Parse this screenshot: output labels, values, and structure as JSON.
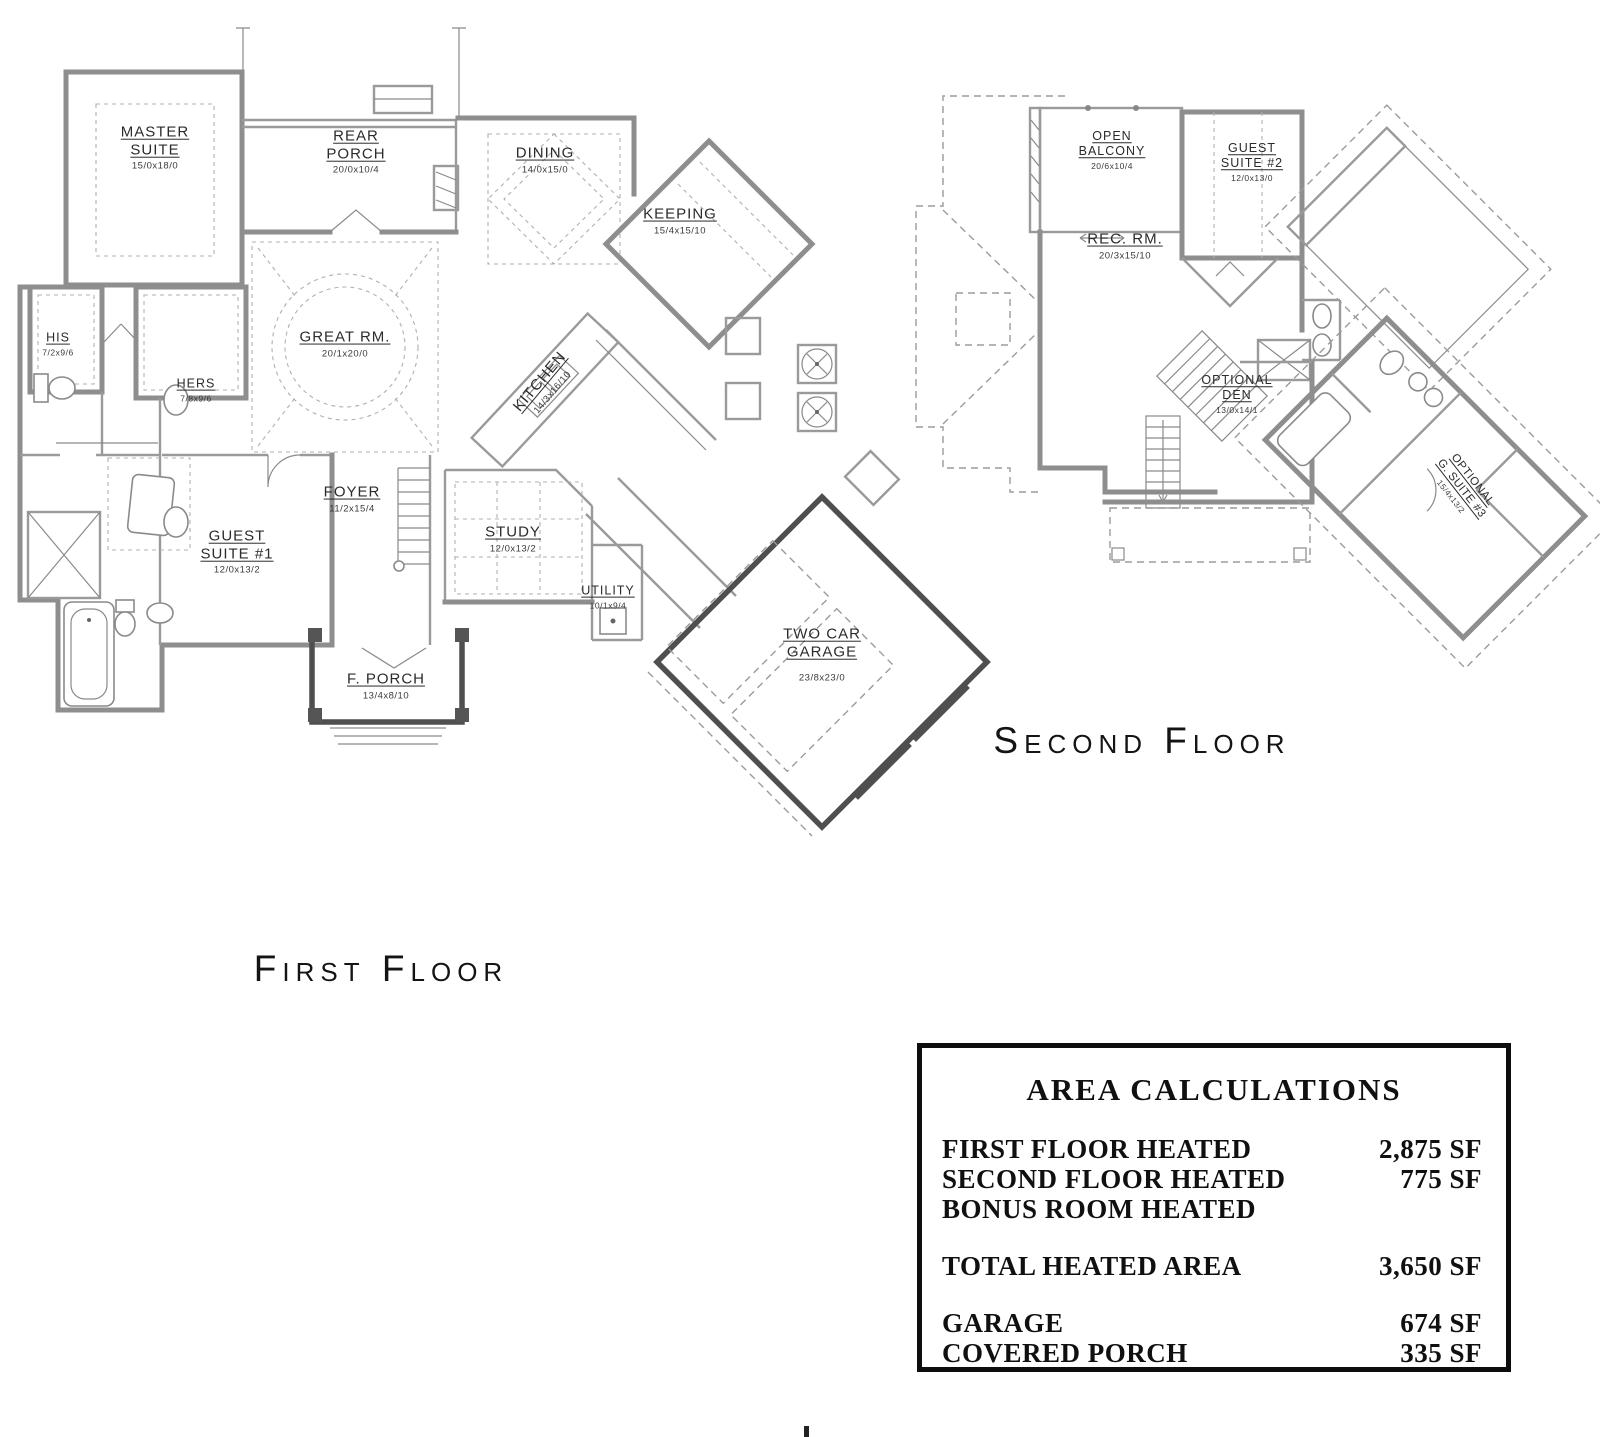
{
  "floor_plan": {
    "first_floor": {
      "title": "First Floor",
      "rooms": {
        "master_suite": {
          "line1": "MASTER",
          "line2": "SUITE",
          "dim": "15/0x18/0"
        },
        "rear_porch": {
          "line1": "REAR",
          "line2": "PORCH",
          "dim": "20/0x10/4"
        },
        "dining": {
          "line1": "DINING",
          "dim": "14/0x15/0"
        },
        "keeping": {
          "line1": "KEEPING",
          "dim": "15/4x15/10"
        },
        "great_rm": {
          "line1": "GREAT RM.",
          "dim": "20/1x20/0"
        },
        "kitchen": {
          "line1": "KITCHEN",
          "dim": "14/3x16/10"
        },
        "his": {
          "line1": "HIS",
          "dim": "7/2x9/6"
        },
        "hers": {
          "line1": "HERS",
          "dim": "7/8x9/6"
        },
        "foyer": {
          "line1": "FOYER",
          "dim": "11/2x15/4"
        },
        "guest_suite_1": {
          "line1": "GUEST",
          "line2": "SUITE #1",
          "dim": "12/0x13/2"
        },
        "study": {
          "line1": "STUDY",
          "dim": "12/0x13/2"
        },
        "utility": {
          "line1": "UTILITY",
          "dim": "10/1x9/4"
        },
        "two_car_garage": {
          "line1": "TWO CAR",
          "line2": "GARAGE",
          "dim": "23/8x23/0"
        },
        "f_porch": {
          "line1": "F. PORCH",
          "dim": "13/4x8/10"
        }
      }
    },
    "second_floor": {
      "title": "Second Floor",
      "rooms": {
        "open_balcony": {
          "line1": "OPEN",
          "line2": "BALCONY",
          "dim": "20/6x10/4"
        },
        "guest_suite_2": {
          "line1": "GUEST",
          "line2": "SUITE #2",
          "dim": "12/0x13/0"
        },
        "rec_rm": {
          "line1": "REC. RM.",
          "dim": "20/3x15/10"
        },
        "optional_den": {
          "line1": "OPTIONAL",
          "line2": "DEN",
          "dim": "13/0x14/1"
        },
        "optional_g_suite_3": {
          "line1": "OPTIONAL",
          "line2": "G. SUITE #3",
          "dim": "15/4x13/2"
        }
      }
    }
  },
  "area_calculations": {
    "title": "AREA CALCULATIONS",
    "rows": [
      {
        "label": "FIRST FLOOR HEATED",
        "value": "2,875 SF"
      },
      {
        "label": "SECOND FLOOR HEATED",
        "value": "775 SF"
      },
      {
        "label": "BONUS ROOM HEATED",
        "value": ""
      },
      {
        "label": "TOTAL HEATED AREA",
        "value": "3,650 SF"
      },
      {
        "label": "GARAGE",
        "value": "674 SF"
      },
      {
        "label": "COVERED PORCH",
        "value": "335 SF"
      }
    ]
  }
}
